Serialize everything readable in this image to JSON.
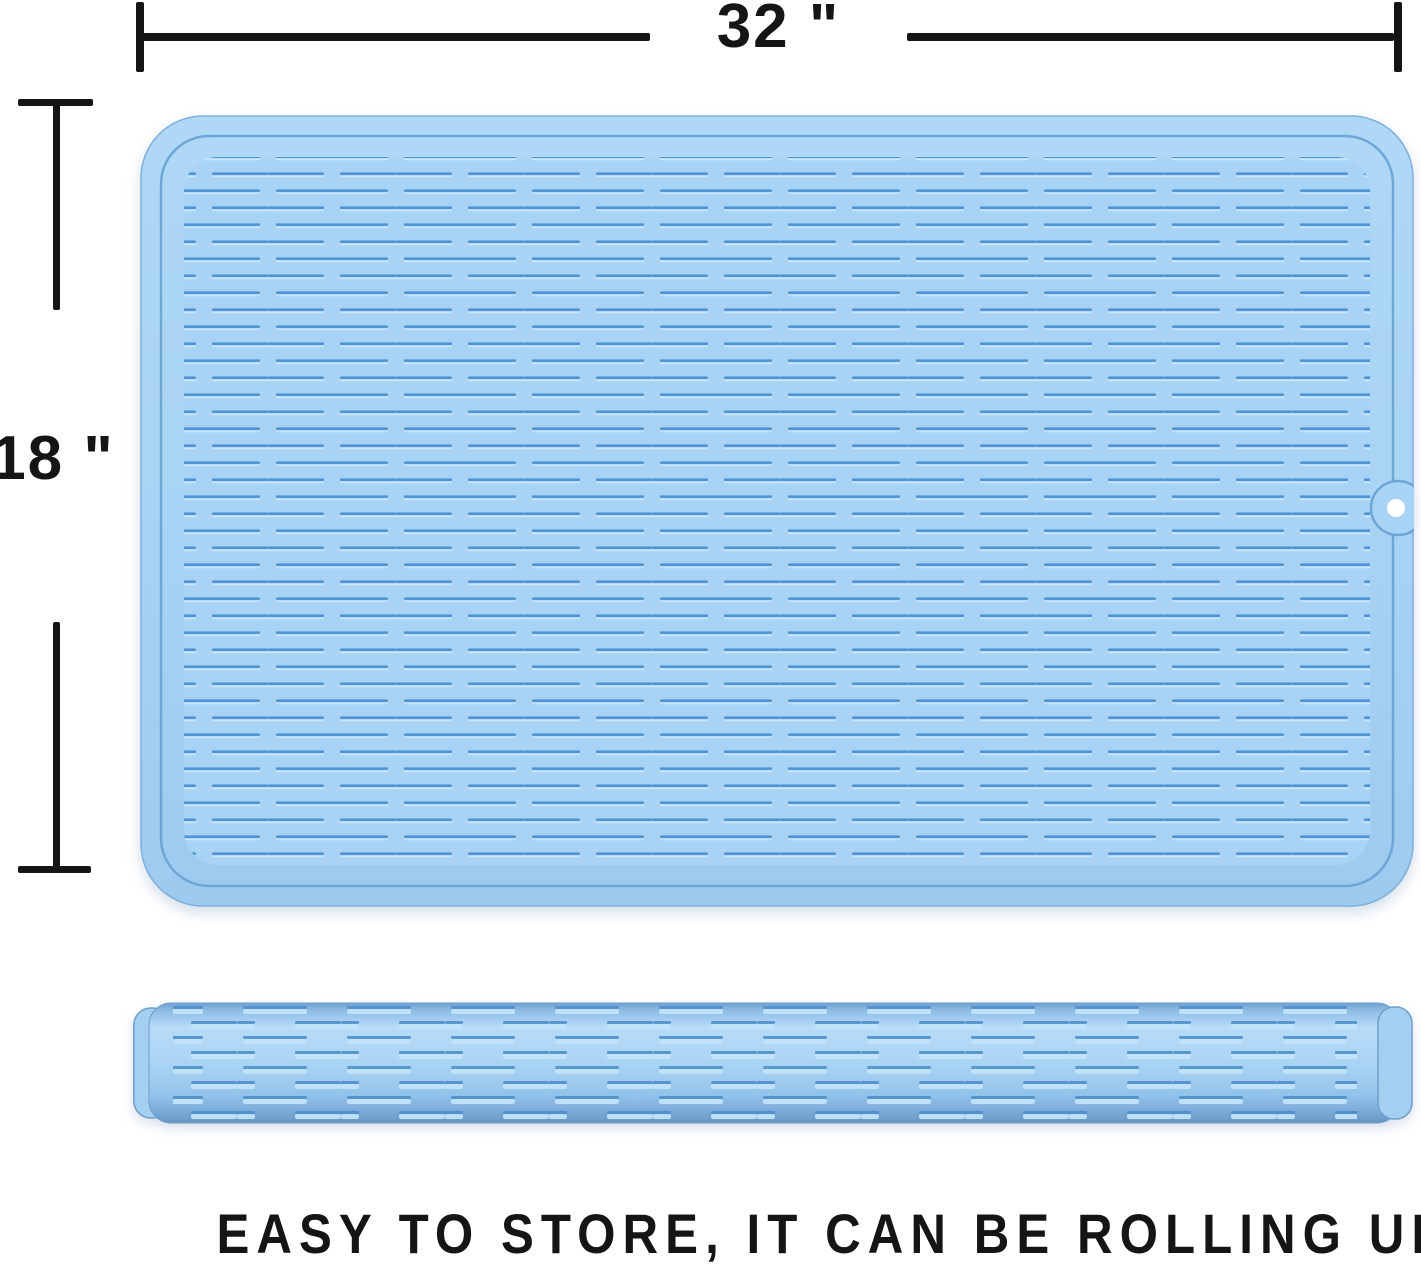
{
  "annotations": {
    "width_label": "32 \"",
    "height_label": "18 \""
  },
  "caption": {
    "text": "EASY TO STORE, IT CAN BE ROLLING UP"
  },
  "colors": {
    "background": "#FFFFFF",
    "annotation_ink": "#151515",
    "mat_base": "#A9D3F4",
    "mat_edge_outline": "#7FAFDC",
    "mat_groove": "#6FA6D8",
    "ridge_dark": "#4E94D6",
    "ridge_highlight": "#CBE6FB",
    "roll_shadow": "#6896C2",
    "roll_highlight": "#B7DBF8",
    "hang_hole": "#FFFFFF"
  }
}
